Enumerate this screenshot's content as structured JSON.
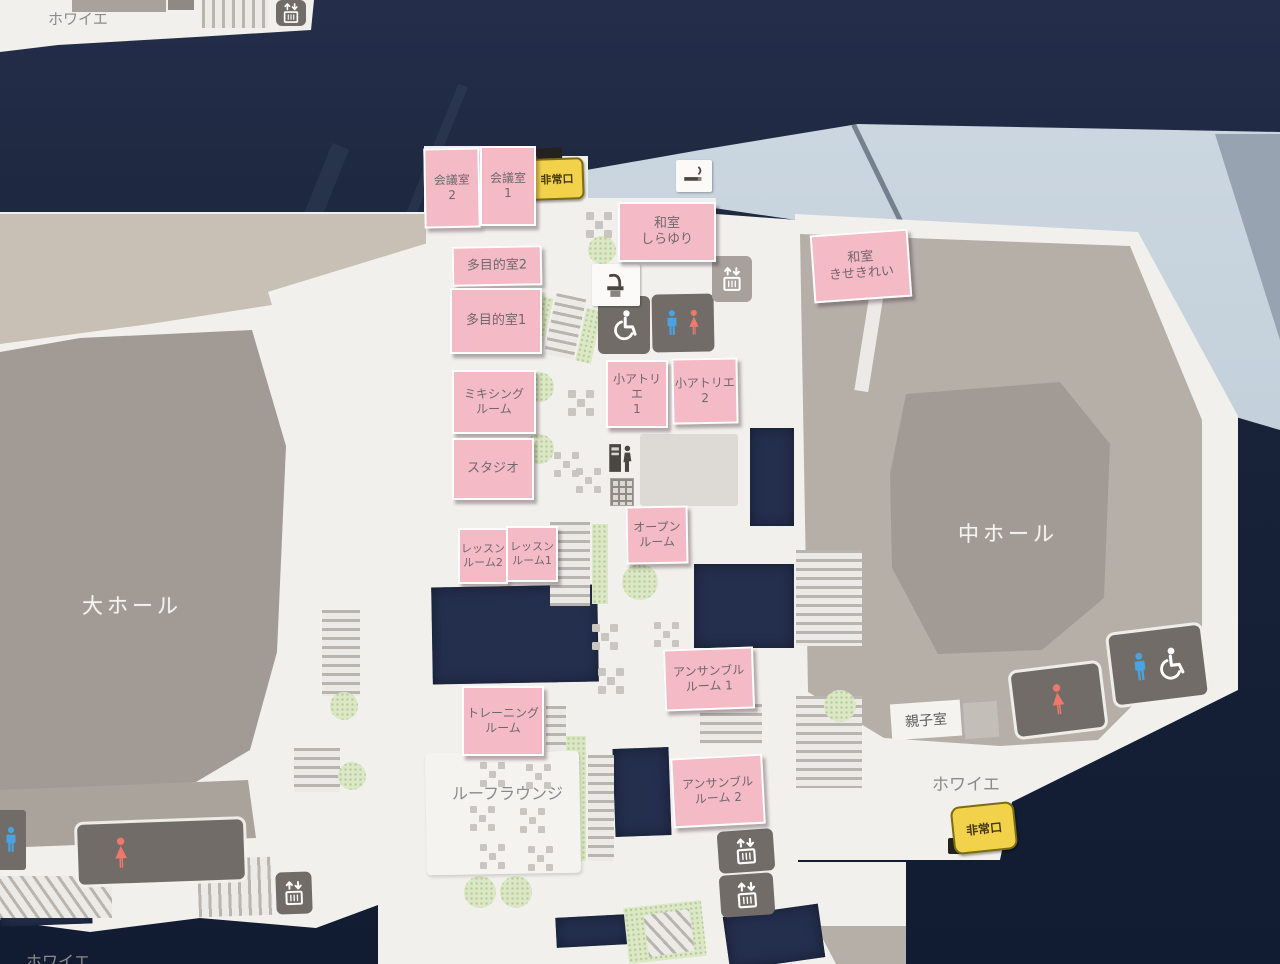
{
  "rooms": {
    "kaigishitsu_2": "会議室\n2",
    "kaigishitsu_1": "会議室\n1",
    "washitsu_shirayuri": "和室\nしらゆり",
    "washitsu_kisekirei": "和室\nきせきれい",
    "tamokutekishitsu_2": "多目的室2",
    "tamokutekishitsu_1": "多目的室1",
    "mixing_room": "ミキシング\nルーム",
    "studio": "スタジオ",
    "atelier_1": "小アトリエ\n1",
    "atelier_2": "小アトリエ\n2",
    "lesson_room_2": "レッスン\nルーム2",
    "lesson_room_1": "レッスン\nルーム1",
    "open_room": "オープン\nルーム",
    "ensemble_room_1": "アンサンブル\nルーム 1",
    "training_room": "トレーニング\nルーム",
    "ensemble_room_2": "アンサンブル\nルーム 2"
  },
  "halls": {
    "large_hall": "大ホール",
    "medium_hall": "中ホール"
  },
  "areas": {
    "foyer_top_left": "ホワイエ",
    "foyer_right": "ホワイエ",
    "foyer_bottom_left": "ホワイエ",
    "roof_lounge": "ルーフラウンジ",
    "parent_child_room": "親子室"
  },
  "signs": {
    "emergency_exit_top": "非常口",
    "emergency_exit_bottom_right": "非常口"
  },
  "colors": {
    "background_navy": "#1d2740",
    "map_white": "#f2f0ec",
    "wall_gray": "#b6afa8",
    "hall_gray": "#a29b95",
    "room_pink": "#f4bac6",
    "exit_yellow": "#f2d24b",
    "green": "#dbe7c6",
    "restroom_dark": "#716c67",
    "male_blue": "#4aa3e0",
    "female_red": "#f0776e"
  }
}
